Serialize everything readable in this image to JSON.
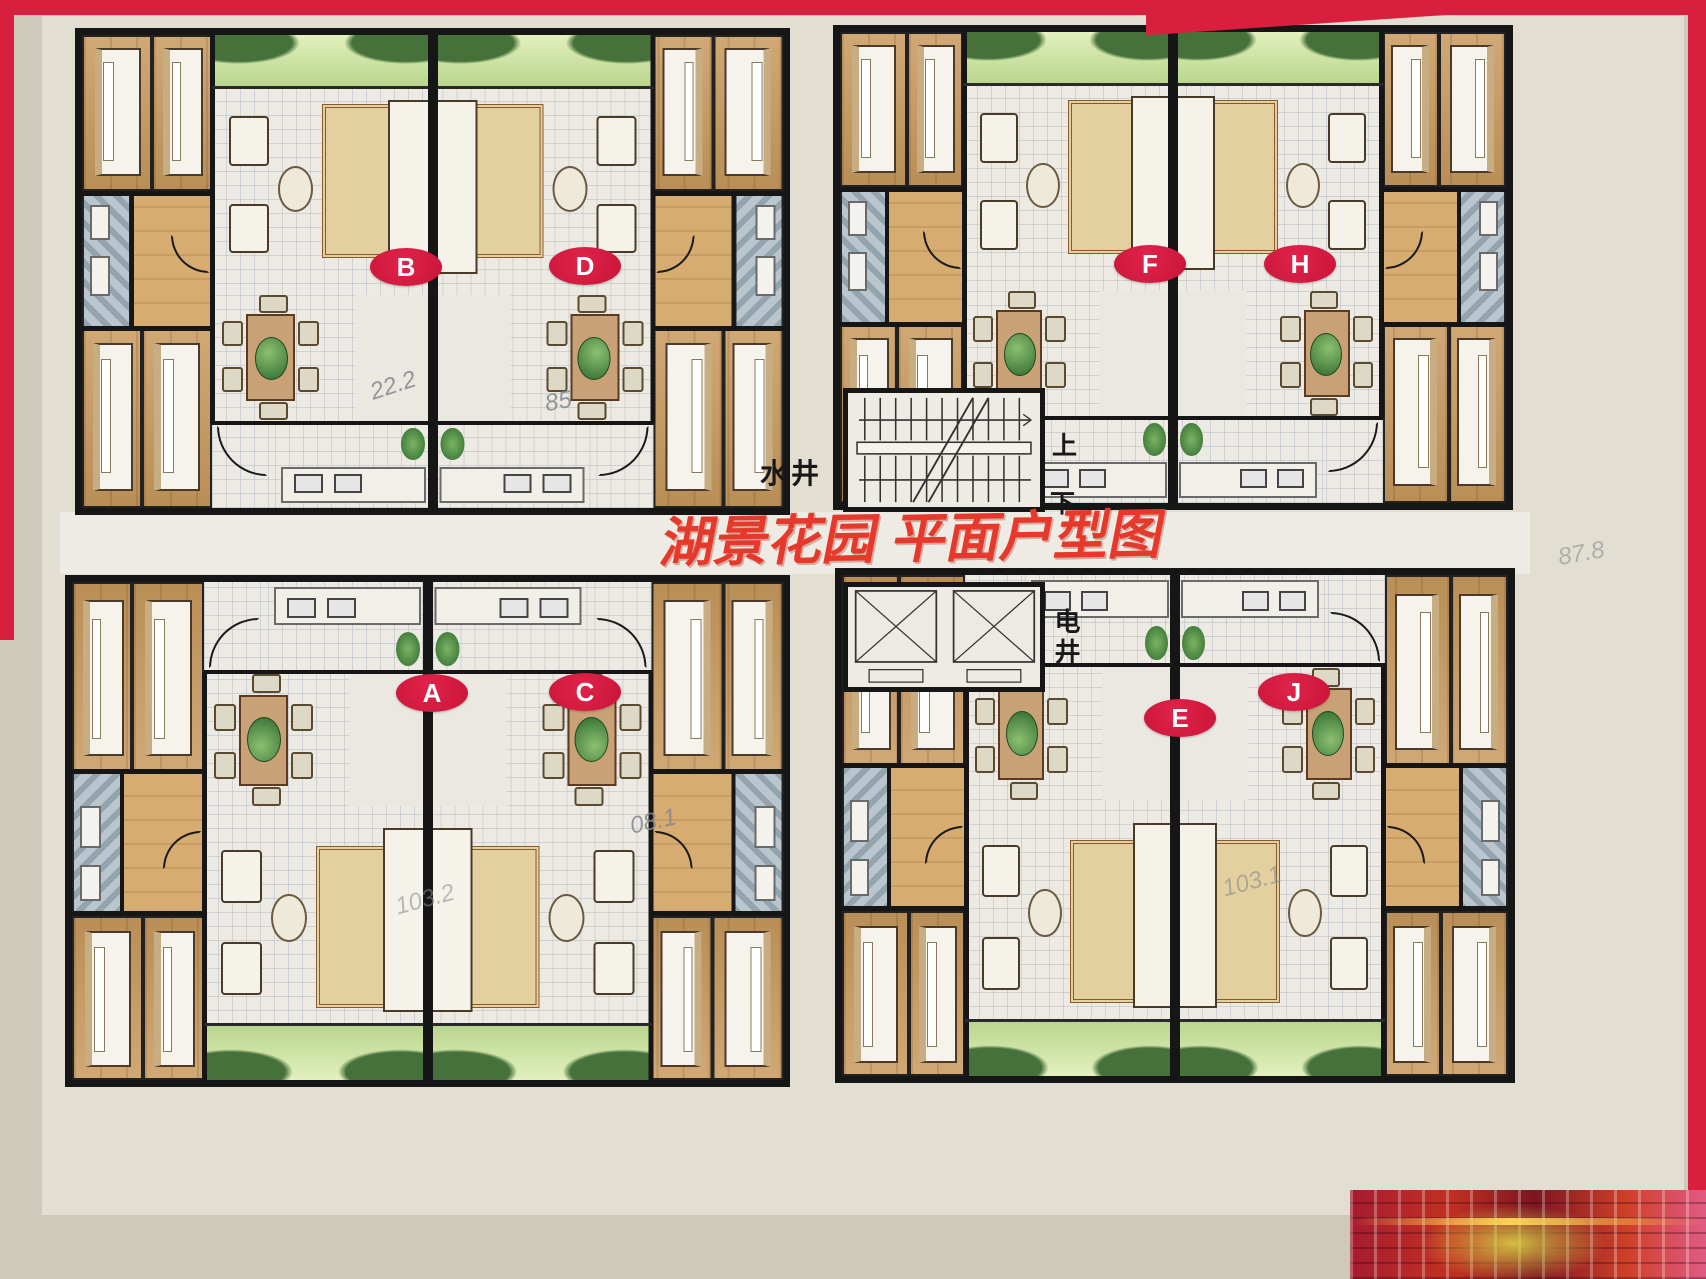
{
  "poster": {
    "title": "湖景花园 平面户型图",
    "title_color": "#e6392b",
    "border_color": "#d81f3d",
    "background_color": "#cfc9ba",
    "paper_color": "#e2ded2"
  },
  "core": {
    "water_shaft_label": "水井",
    "electric_shaft_label": "电井",
    "stairs_up_label": "上",
    "stairs_down_label": "下"
  },
  "buildings": [
    {
      "position": "top-left",
      "units": [
        "B",
        "D"
      ]
    },
    {
      "position": "top-right",
      "units": [
        "F",
        "H"
      ]
    },
    {
      "position": "bottom-left",
      "units": [
        "A",
        "C"
      ]
    },
    {
      "position": "bottom-right",
      "units": [
        "E",
        "J"
      ]
    }
  ],
  "units": [
    {
      "id": "B",
      "building": "top-left",
      "side": "left"
    },
    {
      "id": "D",
      "building": "top-left",
      "side": "right"
    },
    {
      "id": "F",
      "building": "top-right",
      "side": "left"
    },
    {
      "id": "H",
      "building": "top-right",
      "side": "right"
    },
    {
      "id": "A",
      "building": "bottom-left",
      "side": "left"
    },
    {
      "id": "C",
      "building": "bottom-left",
      "side": "right"
    },
    {
      "id": "E",
      "building": "bottom-right",
      "side": "left"
    },
    {
      "id": "J",
      "building": "bottom-right",
      "side": "right"
    }
  ],
  "annotations": [
    {
      "text": "22.2",
      "near_unit": "B",
      "style": "handwritten-pencil"
    },
    {
      "text": "85",
      "near_unit": "D",
      "style": "handwritten-pencil"
    },
    {
      "text": "08.1",
      "near_unit": "C",
      "style": "handwritten-pencil"
    },
    {
      "text": "103.2",
      "near_unit": "A",
      "style": "handwritten-pencil"
    },
    {
      "text": "103.1",
      "near_unit": "E",
      "style": "handwritten-pencil"
    },
    {
      "text": "87.8",
      "near_unit": "H",
      "style": "handwritten-pencil"
    }
  ],
  "colors": {
    "badge_red": "#d61e44",
    "wall_black": "#161616",
    "wood_floor": "#c99a5e",
    "bath_tile": "#b9c6cd",
    "balcony_green": "#b9d68d",
    "pencil_gray": "#85888e"
  }
}
